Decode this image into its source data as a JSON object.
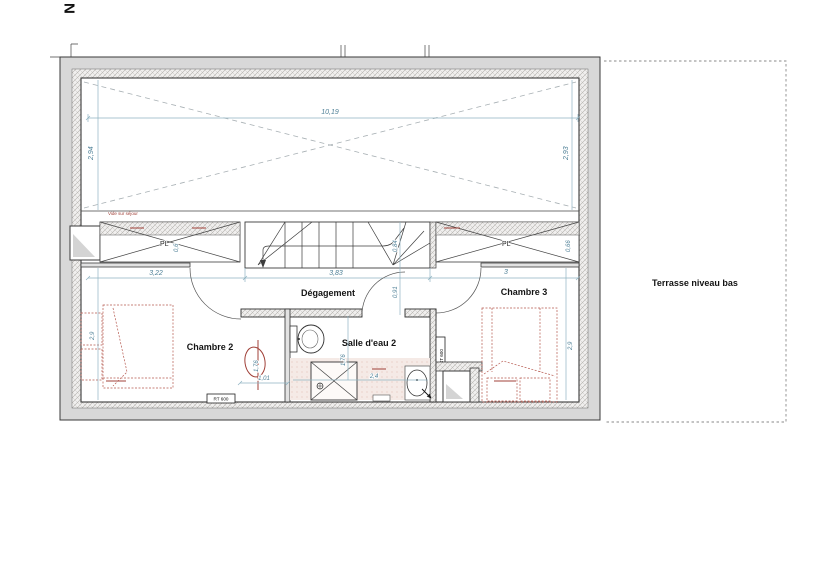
{
  "title": "Floor plan - niveau étage",
  "labels": {
    "north": "N",
    "degagement": "Dégagement",
    "chambre2": "Chambre 2",
    "chambre3": "Chambre 3",
    "salle_eau": "Salle d'eau 2",
    "terrasse": "Terrasse niveau bas",
    "vide": "Vide sur séjour",
    "pl_left": "PL",
    "pl_right": "PL",
    "radiator_chambre2": "RT 600",
    "radiator_chambre3": "RT 600"
  },
  "dimensions": {
    "top_width": "10,19",
    "void_left_height": "2,94",
    "void_right_height": "2,93",
    "mid_left": "3,22",
    "mid_center": "3,83",
    "mid_right": "3",
    "pl_left_depth": "0,6",
    "pl_right_depth": "0,66",
    "stair_winder": "0,84",
    "corridor_width": "0,91",
    "chambre2_depth": "2,9",
    "chambre3_depth": "2,9",
    "chambre2_door": "1,01",
    "modified_dim": "1,76",
    "bath_width": "2,4"
  },
  "colors": {
    "dim-blue": "#4d7f96",
    "dim-line": "#8fb3c2",
    "bed-red": "#b5584e",
    "ann-red": "#a04038",
    "wall-fill": "#d8d8d8",
    "wall-edge": "#3a3a3a",
    "void-dash": "#a8b0b4",
    "terr-dash": "#8a8a8a",
    "floor-pink": "#f5eae6",
    "label-black": "#141414"
  }
}
